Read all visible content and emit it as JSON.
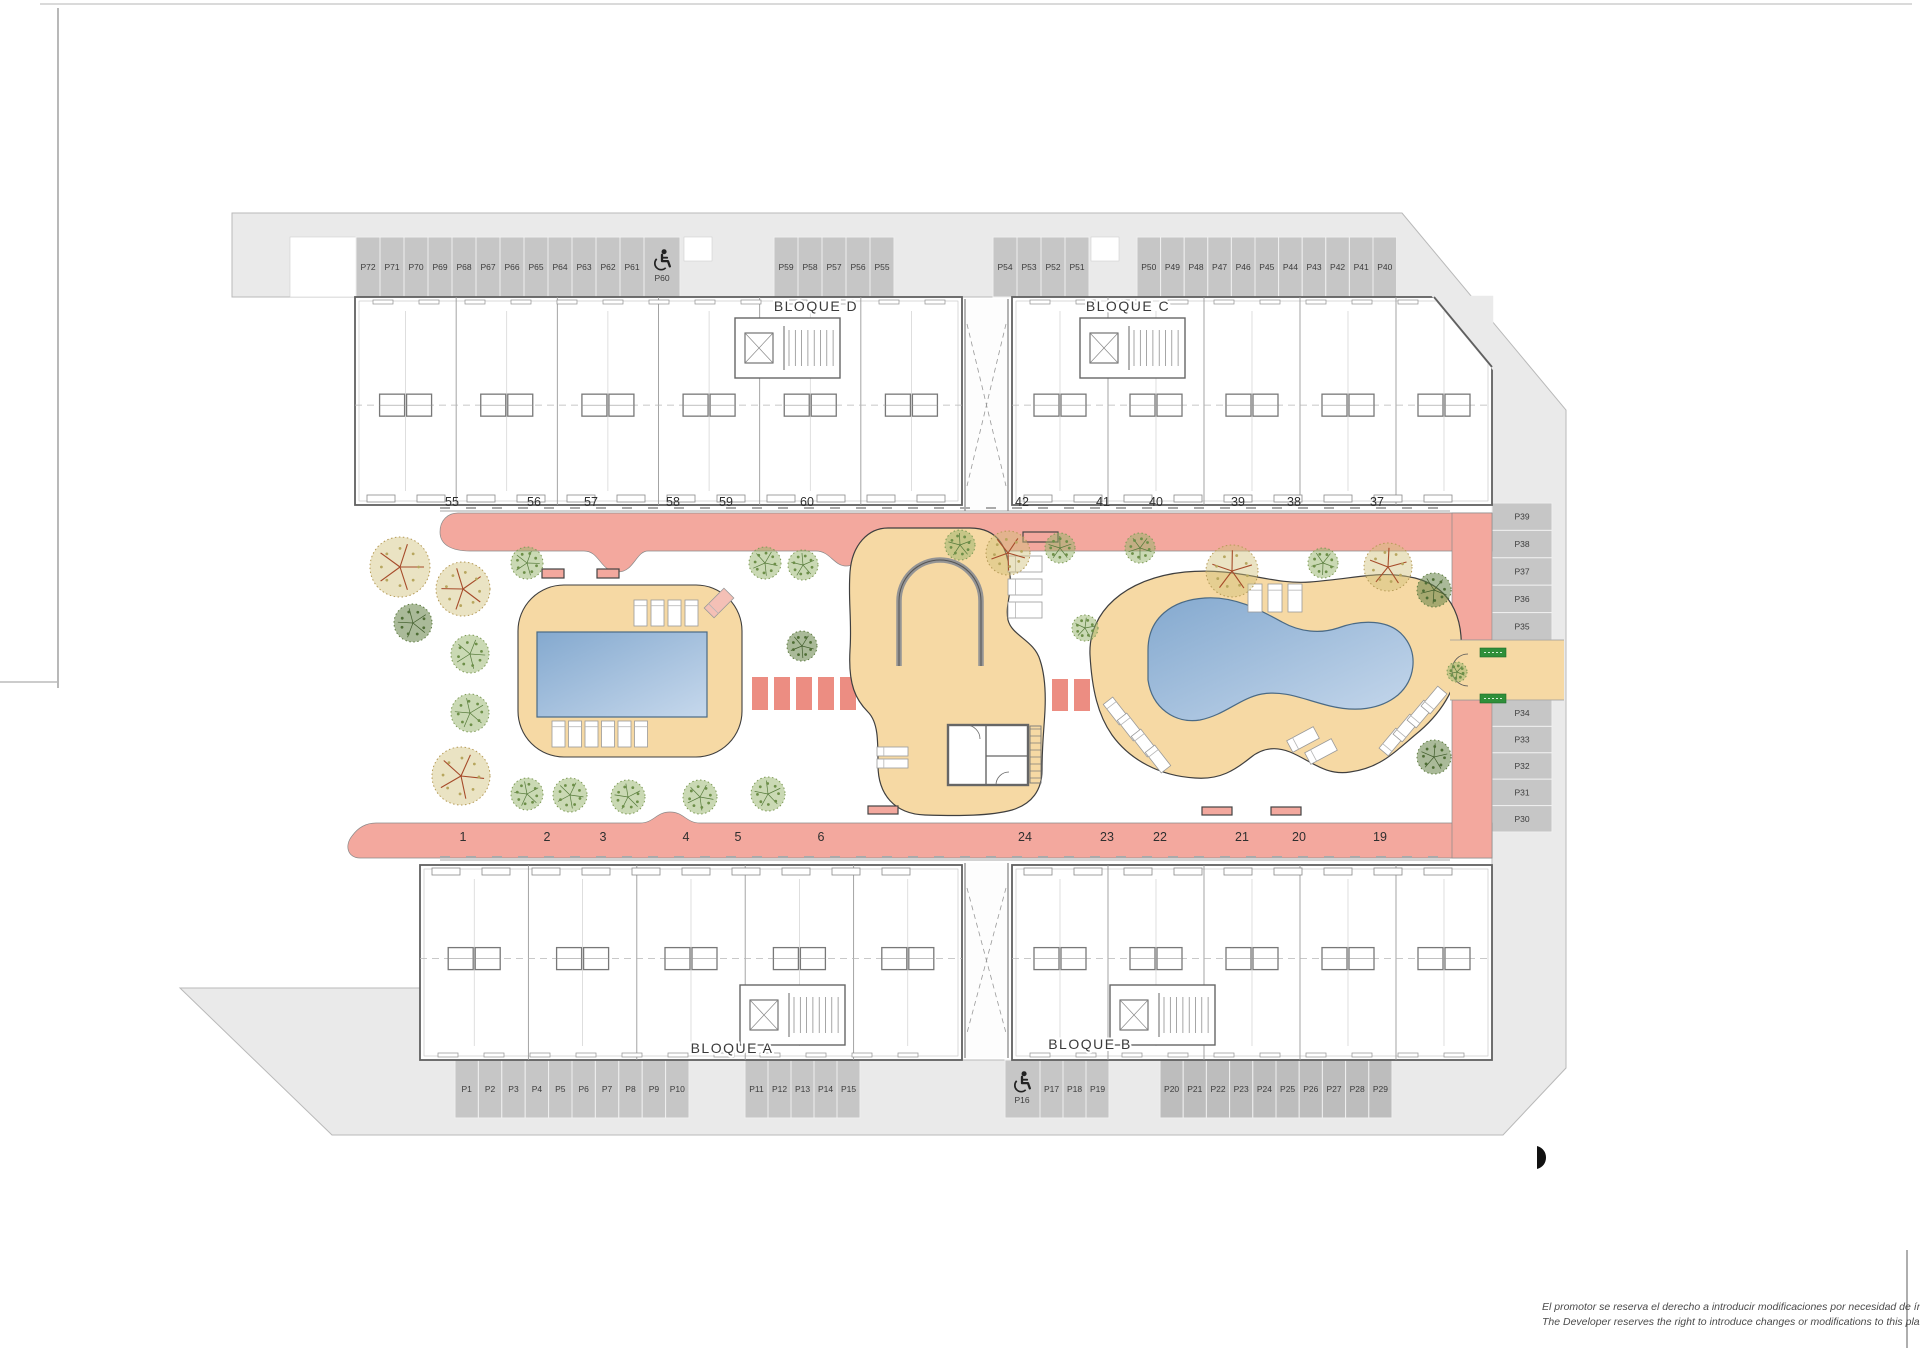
{
  "bloques": {
    "d": "BLOQUE D",
    "c": "BLOQUE C",
    "a": "BLOQUE A",
    "b": "BLOQUE B"
  },
  "units": {
    "top_left": [
      "55",
      "56",
      "57",
      "58",
      "59",
      "60"
    ],
    "top_right": [
      "42",
      "41",
      "40",
      "39",
      "38",
      "37"
    ],
    "bottom_left": [
      "1",
      "2",
      "3",
      "4",
      "5",
      "6"
    ],
    "bottom_right": [
      "24",
      "23",
      "22",
      "21",
      "20",
      "19"
    ]
  },
  "parking": {
    "top1": [
      "P72",
      "P71",
      "P70",
      "P69",
      "P68",
      "P67",
      "P66",
      "P65",
      "P64",
      "P63",
      "P62",
      "P61"
    ],
    "top1_accessible": "P60",
    "top2": [
      "P59",
      "P58",
      "P57",
      "P56",
      "P55"
    ],
    "top3": [
      "P54",
      "P53",
      "P52",
      "P51"
    ],
    "top4": [
      "P50",
      "P49",
      "P48",
      "P47",
      "P46",
      "P45",
      "P44",
      "P43",
      "P42",
      "P41",
      "P40"
    ],
    "right_top": [
      "P39",
      "P38",
      "P37",
      "P36",
      "P35"
    ],
    "right_bottom": [
      "P34",
      "P33",
      "P32",
      "P31",
      "P30"
    ],
    "bottom1": [
      "P1",
      "P2",
      "P3",
      "P4",
      "P5",
      "P6",
      "P7",
      "P8",
      "P9",
      "P10"
    ],
    "bottom2": [
      "P11",
      "P12",
      "P13",
      "P14",
      "P15"
    ],
    "bottom3_accessible": "P16",
    "bottom3": [
      "P17",
      "P18",
      "P19"
    ],
    "bottom4": [
      "P20",
      "P21",
      "P22",
      "P23",
      "P24",
      "P25",
      "P26",
      "P27",
      "P28",
      "P29"
    ]
  },
  "icons": {
    "accessible_parking": "wheelchair-icon"
  },
  "disclaimer": {
    "es": "El promotor se reserva el derecho a introducir modificaciones por necesidad de índole técnica o legal.",
    "en": "The Developer reserves the right to introduce changes or modifications to this plan due to legal or tech"
  },
  "colors": {
    "road": "#eaeaea",
    "road_edge": "#b9b9b9",
    "stall": "#c6c6c6",
    "stall_dark": "#bdbdbd",
    "stall_line": "#efefef",
    "walkway": "#f3a89e",
    "walkway_edge": "#8a8a8a",
    "crosswalk": "#ec8d82",
    "deck": "#f6d9a4",
    "deck_edge": "#3f3f3f",
    "pool_start": "#84a9cf",
    "pool_end": "#c6d8ec",
    "pool_edge": "#4a6a85",
    "wall": "#606060",
    "badge": "#2f8f3a"
  }
}
